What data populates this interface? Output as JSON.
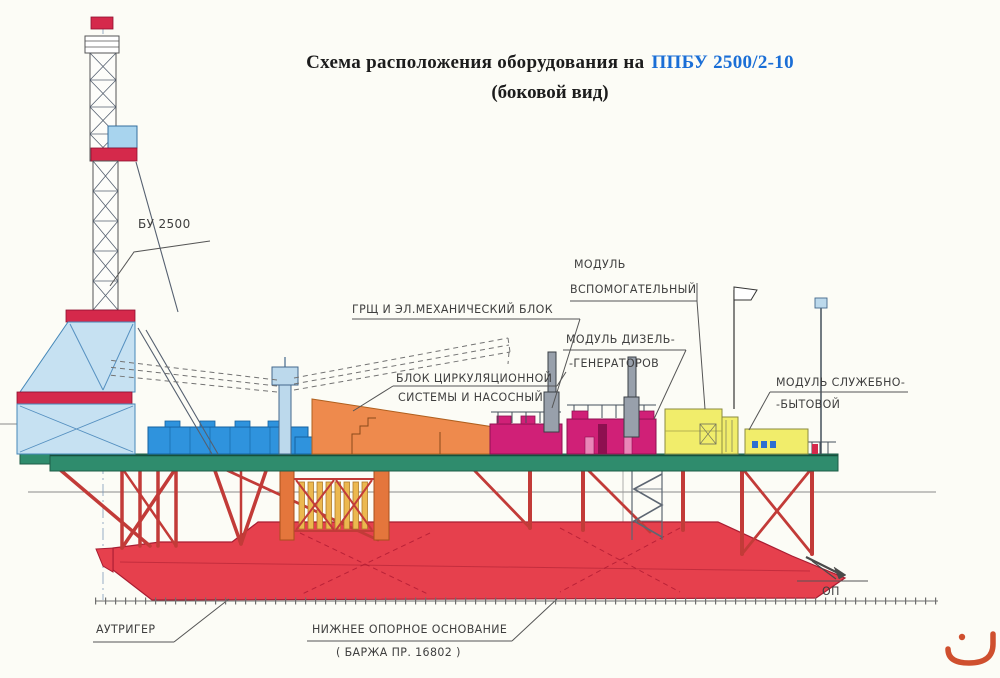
{
  "title": {
    "text_black": "Схема расположения оборудования на",
    "text_blue": "ППБУ 2500/2-10",
    "subtitle": "(боковой вид)"
  },
  "labels": {
    "derrick": "БУ 2500",
    "switchboard_block": "ГРЩ И ЭЛ.МЕХАНИЧЕСКИЙ БЛОК",
    "aux_module": [
      "МОДУЛЬ",
      "ВСПОМОГАТЕЛЬНЫЙ"
    ],
    "diesel_module": [
      "МОДУЛЬ ДИЗЕЛЬ-",
      "-ГЕНЕРАТОРОВ"
    ],
    "circulation_block": [
      "БЛОК ЦИРКУЛЯЦИОННОЙ",
      "СИСТЕМЫ И НАСОСНЫЙ"
    ],
    "service_module": [
      "МОДУЛЬ СЛУЖЕБНО-",
      "-БЫТОВОЙ"
    ],
    "outrigger": "АУТРИГЕР",
    "lower_base": [
      "НИЖНЕЕ ОПОРНОЕ ОСНОВАНИЕ",
      "( БАРЖА ПР. 16802 )"
    ],
    "op_mark": "ОП"
  },
  "icons": {
    "watermark": "orange-noon-glyph"
  },
  "colors": {
    "title_highlight": "#1a6ed6",
    "hull_red": "#e6404d",
    "band_red": "#d5294b",
    "truss_red": "#c23b38",
    "deck_green": "#2f8c6d",
    "derrick_light_blue": "#c6e1f2",
    "deckhouse_blue": "#2f93dd",
    "circulation_orange": "#ee8a4d",
    "diesel_magenta": "#d02077",
    "module_yellow": "#f1ed6b",
    "pipe_rack_orange": "#e4763c",
    "watermark_orange": "#cf4f2e"
  }
}
